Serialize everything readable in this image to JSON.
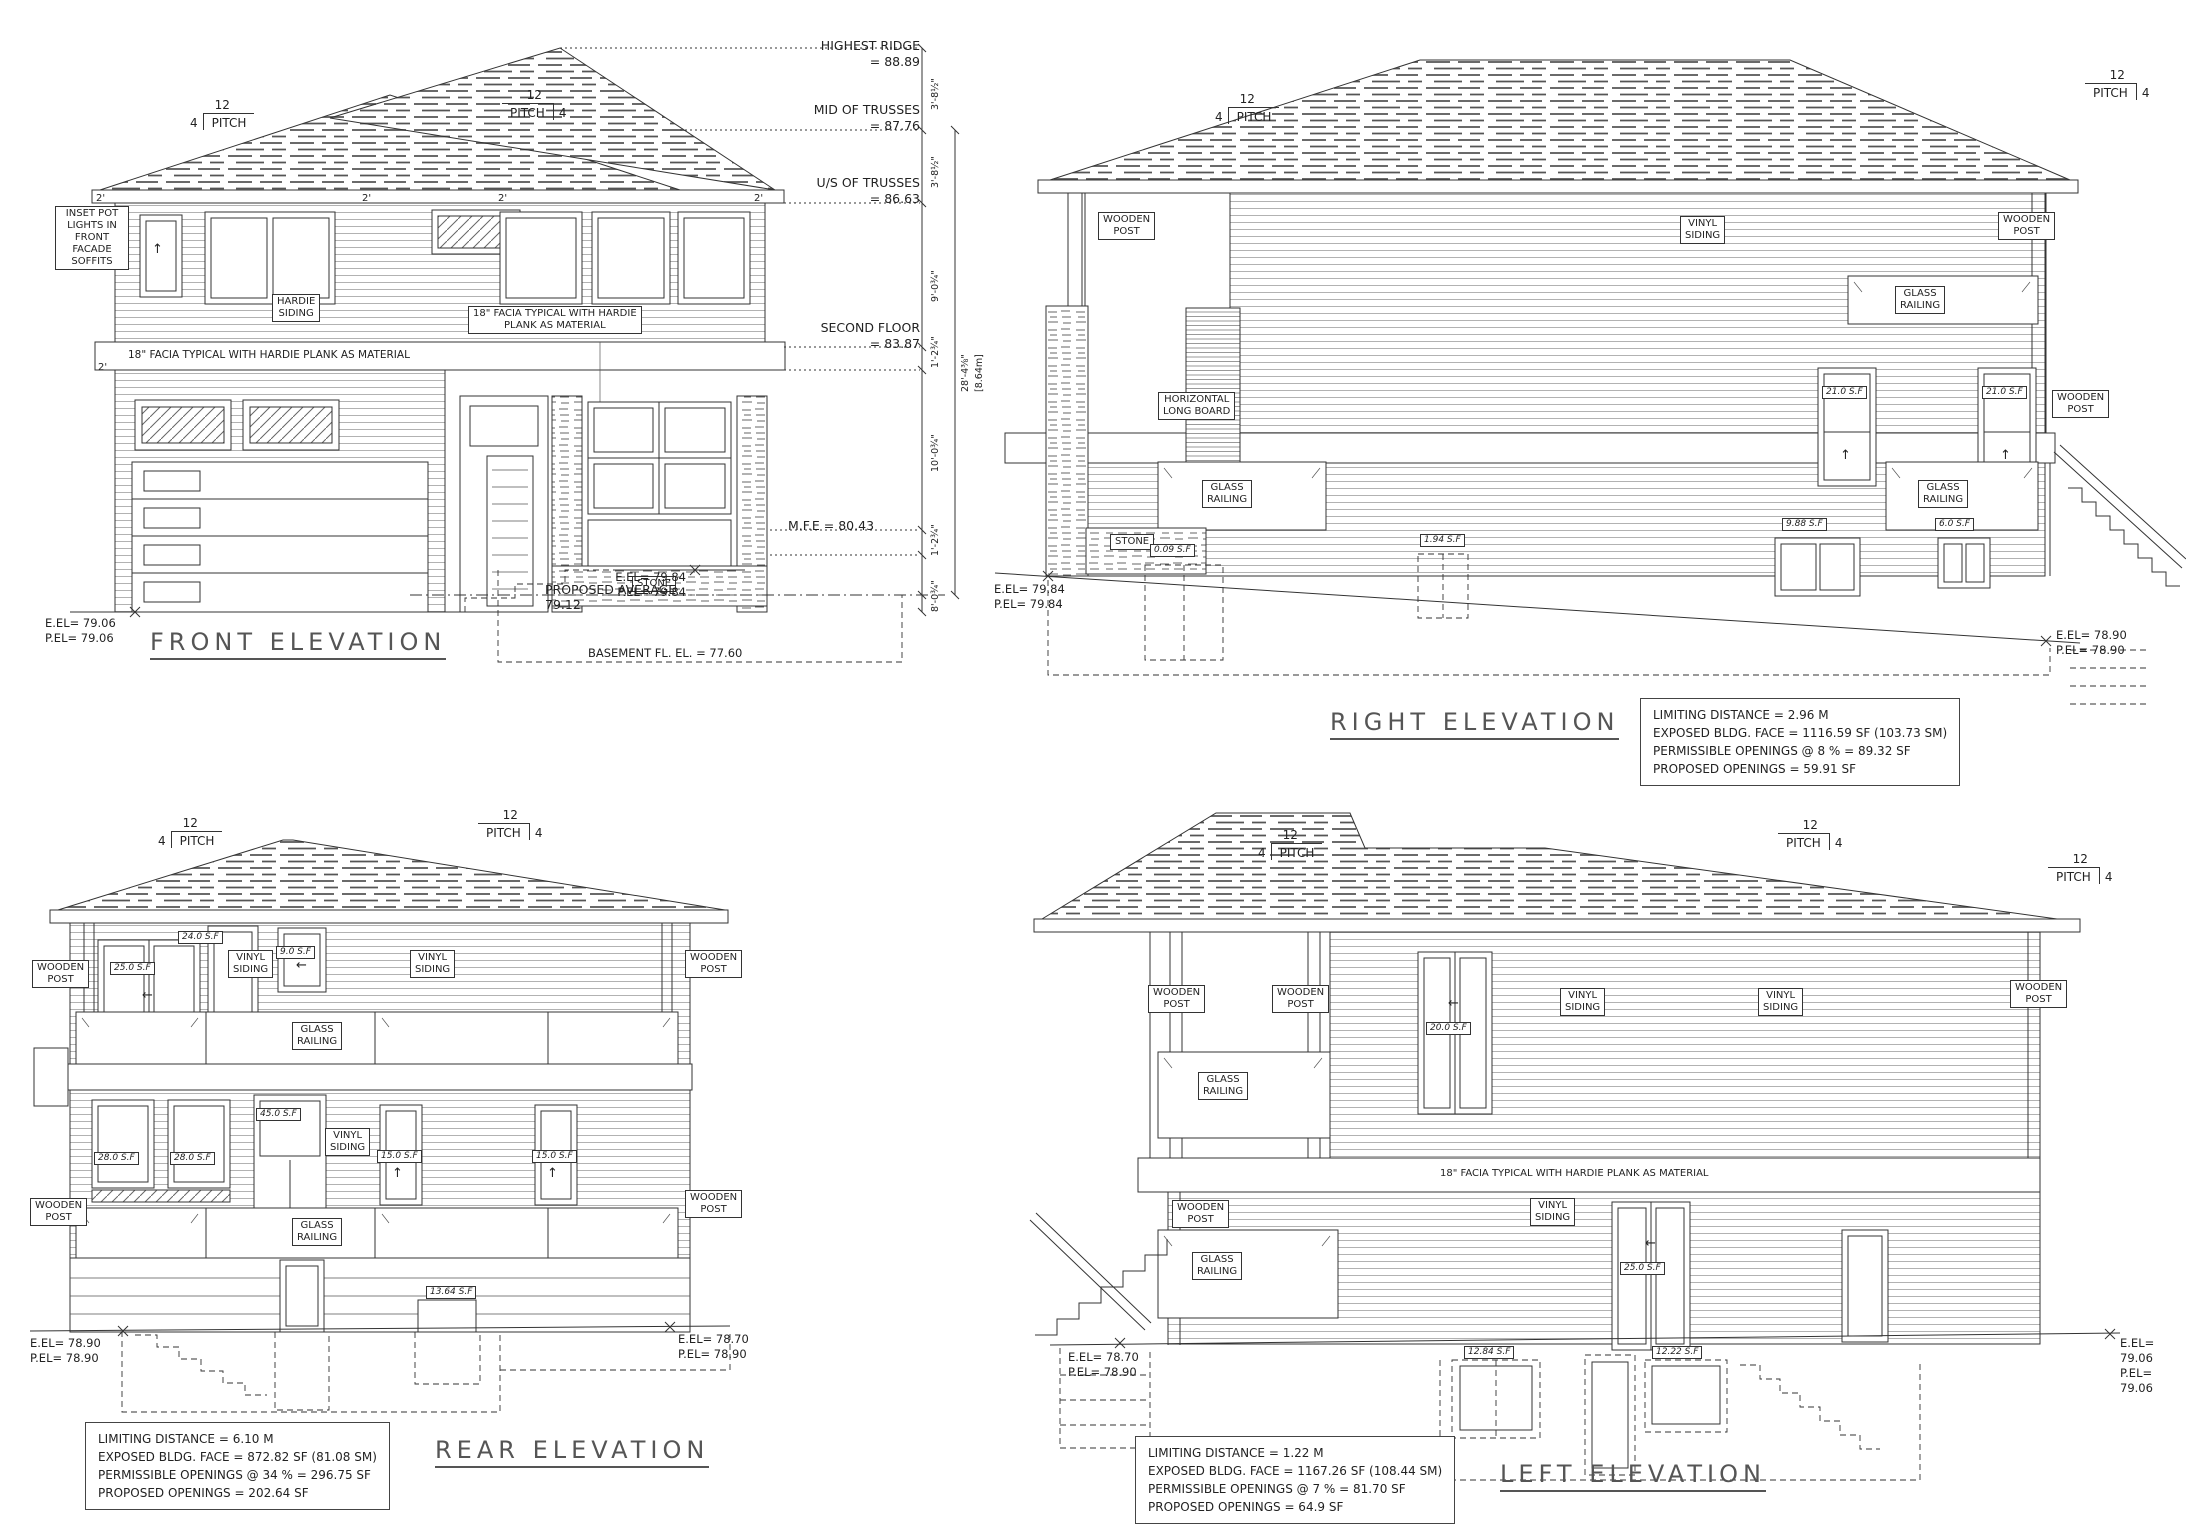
{
  "labels": {
    "wooden_post": "WOODEN\nPOST",
    "glass_railing": "GLASS\nRAILING",
    "vinyl_siding": "VINYL\nSIDING",
    "horizontal_long_board": "HORIZONTAL\nLONG BOARD",
    "hardie_siding": "HARDIE\nSIDING",
    "stone": "STONE",
    "facia_plain": "18\" FACIA TYPICAL WITH HARDIE PLANK AS MATERIAL",
    "facia_boxed": "18\" FACIA TYPICAL WITH HARDIE\nPLANK AS MATERIAL",
    "inset_pot_lights": "INSET POT\nLIGHTS IN\nFRONT\nFACADE\nSOFFITS",
    "pitch_num": "12",
    "pitch_word": "PITCH",
    "pitch_val": "4",
    "dim_2ft": "2'"
  },
  "front": {
    "title": "FRONT ELEVATION",
    "levels": {
      "highest_ridge": "HIGHEST RIDGE\n= 88.89",
      "mid_trusses": "MID OF TRUSSES\n=    87.76",
      "us_trusses": "U/S OF TRUSSES\n= 86.63",
      "second_floor": "SECOND FLOOR\n= 83.87",
      "mfe": "M.F.E = 80.43",
      "proposed_average": "PROPOSED AVERAGE\n79.12",
      "basement": "BASEMENT FL. EL. = 77.60"
    },
    "dims": {
      "a": "3'-8½\"",
      "b": "3'-8½\"",
      "c": "9'-0¾\"",
      "d": "1'-2¾\"",
      "e": "10'-0¾\"",
      "f": "1'-2¾\"",
      "g": "8'-0¾\"",
      "overall": "28'-4⅜\"",
      "overall_m": "[8.64m]"
    },
    "grade_left": "E.EL= 79.06\nP.EL= 79.06",
    "grade_right": "E.EL= 79.84\nP.EL= 79.84"
  },
  "right_elev": {
    "title": "RIGHT ELEVATION",
    "sf": {
      "w21a": "21.0 S.F",
      "w21b": "21.0 S.F",
      "s009": "0.09 S.F",
      "s194": "1.94 S.F",
      "s988": "9.88 S.F",
      "s60": "6.0 S.F"
    },
    "grade_left": "E.EL= 79.84\nP.EL= 79.84",
    "grade_right": "E.EL= 78.90\nP.EL= 78.90",
    "notes": "LIMITING DISTANCE = 2.96 M\nEXPOSED BLDG. FACE = 1116.59 SF (103.73 SM)\nPERMISSIBLE OPENINGS @ 8 % = 89.32 SF\nPROPOSED OPENINGS = 59.91 SF"
  },
  "rear": {
    "title": "REAR ELEVATION",
    "sf": {
      "s250": "25.0 S.F",
      "s240": "24.0 S.F",
      "s90": "9.0 S.F",
      "s450": "45.0 S.F",
      "s280": "28.0 S.F",
      "s150": "15.0 S.F",
      "s1364": "13.64 S.F"
    },
    "grade_left": "E.EL= 78.90\nP.EL= 78.90",
    "grade_right": "E.EL= 78.70\nP.EL= 78.90",
    "notes": "LIMITING DISTANCE = 6.10 M\nEXPOSED BLDG. FACE = 872.82 SF (81.08 SM)\nPERMISSIBLE OPENINGS @ 34 % = 296.75 SF\nPROPOSED OPENINGS = 202.64 SF"
  },
  "left_elev": {
    "title": "LEFT ELEVATION",
    "sf": {
      "s200": "20.0 S.F",
      "s250": "25.0 S.F",
      "s1284": "12.84 S.F",
      "s1222": "12.22 S.F"
    },
    "grade_left": "E.EL= 78.70\nP.EL= 78.90",
    "grade_right": "E.EL= 79.06\nP.EL= 79.06",
    "notes": "LIMITING DISTANCE = 1.22 M\nEXPOSED BLDG. FACE = 1167.26 SF (108.44 SM)\nPERMISSIBLE OPENINGS @ 7 % = 81.70 SF\nPROPOSED OPENINGS = 64.9 SF"
  }
}
